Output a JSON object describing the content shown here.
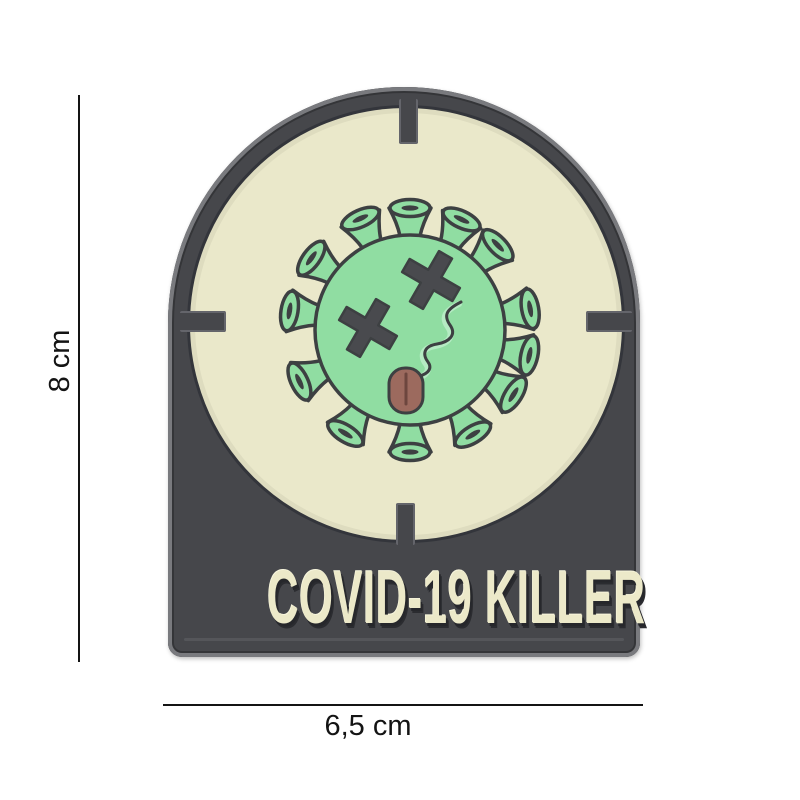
{
  "product_photo": {
    "patch": {
      "title": "COVID-19 KILLER",
      "icon": "coronavirus-dead-face-icon",
      "description_of_artwork": "dark arch-shaped PVC patch, glow reticle circle with four crosshair notches, green coronavirus with crossed-out eyes and tongue sticking out",
      "colors": {
        "patch_dark": "#46474b",
        "patch_edge": "#797a7e",
        "cream": "#eae8ca",
        "circle_outline": "#33353b",
        "virus_green": "#90dda2",
        "virus_green_dark": "#6cc488",
        "virus_outline": "#3d4042",
        "eye_gray": "#494a4e",
        "tongue": "#9c6a5e",
        "text_cream": "#ece9c9"
      }
    },
    "dimension_annotations": {
      "height_label": "8 cm",
      "width_label": "6,5 cm",
      "line_color": "#141414"
    }
  }
}
